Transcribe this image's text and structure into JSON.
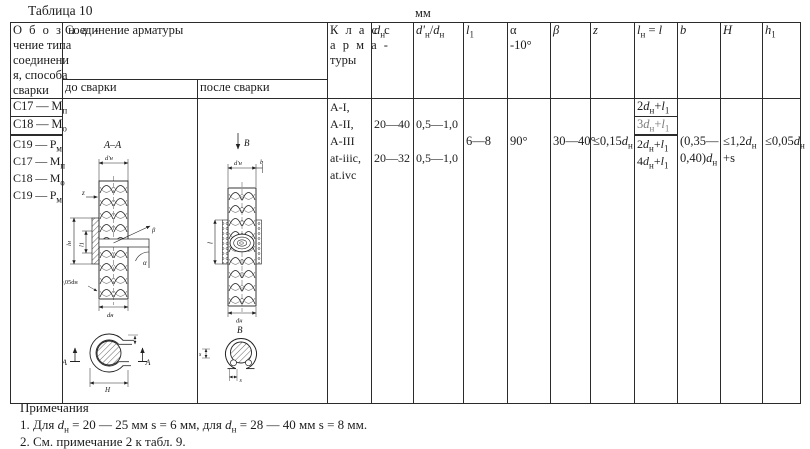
{
  "title": "Таблица 10",
  "unit_label": "мм",
  "header": {
    "col1_lines": [
      "О б о з н а -",
      "чение типа",
      "соединени",
      "я, способа",
      "сварки"
    ],
    "group": "Соединение арматуры",
    "sub_before": "до сварки",
    "sub_after": "после сварки",
    "class_lines": [
      "К л а с с",
      "а р м а -",
      "туры"
    ],
    "d_n": [
      {
        "t": "d",
        "i": true
      },
      {
        "t": "н",
        "s": true
      }
    ],
    "d_ratio": [
      {
        "t": "d'",
        "i": true
      },
      {
        "t": "н",
        "s": true
      },
      "/",
      {
        "t": "d",
        "i": true
      },
      {
        "t": "н",
        "s": true
      }
    ],
    "l_1": [
      {
        "t": "l",
        "i": true
      },
      {
        "t": "1",
        "s": true
      }
    ],
    "alpha_line1": "α",
    "alpha_line2": "-10°",
    "beta": [
      {
        "t": "β",
        "i": true
      }
    ],
    "z": [
      {
        "t": "z",
        "i": true
      }
    ],
    "l_n_eq": [
      {
        "t": "l",
        "i": true
      },
      {
        "t": "н",
        "s": true
      },
      " = ",
      {
        "t": "l",
        "i": true
      }
    ],
    "b": [
      {
        "t": "b",
        "i": true
      }
    ],
    "H": [
      {
        "t": "H",
        "i": true
      }
    ],
    "h_1": [
      {
        "t": "h",
        "i": true
      },
      {
        "t": "1",
        "s": true
      }
    ]
  },
  "rows": {
    "designation_r1": [
      "С17 — М",
      {
        "t": "п",
        "s": true
      }
    ],
    "designation_r2": [
      "С18 — М",
      {
        "t": "о",
        "s": true
      }
    ],
    "designation_r3": [
      [
        "С19 — Р",
        {
          "t": "м",
          "s": true
        }
      ],
      [
        "С17 — М",
        {
          "t": "п",
          "s": true
        }
      ],
      [
        "С18 — М",
        {
          "t": "о",
          "s": true
        }
      ],
      [
        "С19 — Р",
        {
          "t": "м",
          "s": true
        }
      ]
    ],
    "class_lines": [
      "A-I,",
      "A-II,",
      "A-III",
      "at-iiic,",
      "at.ivc"
    ],
    "d_n_lines": [
      "",
      "20—40",
      "",
      "20—32"
    ],
    "d_ratio_lines": [
      "",
      "0,5—1,0",
      "",
      "0,5—1,0"
    ],
    "l_1_val": "6—8",
    "alpha_val": "90°",
    "beta_val": "30—40°",
    "z_val": [
      "≤0,15",
      {
        "t": "d",
        "i": true
      },
      {
        "t": "н",
        "s": true
      }
    ],
    "l_n_r1": [
      "2",
      {
        "t": "d",
        "i": true
      },
      {
        "t": "н",
        "s": true
      },
      "+",
      {
        "t": "l",
        "i": true
      },
      {
        "t": "1",
        "s": true
      }
    ],
    "l_n_r2": [
      "3",
      {
        "t": "d",
        "i": true
      },
      {
        "t": "н",
        "s": true
      },
      "+",
      {
        "t": "l",
        "i": true
      },
      {
        "t": "1",
        "s": true
      }
    ],
    "l_n_r3a": [
      "2",
      {
        "t": "d",
        "i": true
      },
      {
        "t": "н",
        "s": true
      },
      "+",
      {
        "t": "l",
        "i": true
      },
      {
        "t": "1",
        "s": true
      }
    ],
    "l_n_r3b": [
      "4",
      {
        "t": "d",
        "i": true
      },
      {
        "t": "н",
        "s": true
      },
      "+",
      {
        "t": "l",
        "i": true
      },
      {
        "t": "1",
        "s": true
      }
    ],
    "b_line1": "(0,35—",
    "b_line2": [
      "0,40)",
      {
        "t": "d",
        "i": true
      },
      {
        "t": "н",
        "s": true
      }
    ],
    "H_line1": [
      "≤1,2",
      {
        "t": "d",
        "i": true
      },
      {
        "t": "н",
        "s": true
      }
    ],
    "H_line2": "+s",
    "h_1_val": [
      "≤0,05",
      {
        "t": "d",
        "i": true
      },
      {
        "t": "н",
        "s": true
      }
    ]
  },
  "drawings": {
    "before": {
      "section": "А–А",
      "d_top": "d'н",
      "z": "z",
      "beta": "β",
      "alpha": "α",
      "dim_l1": "l1",
      "dim_ln": "lн",
      "note": "≤0,05dн",
      "d_bot": "dн",
      "sec_mark": "А",
      "h_dim": "Н"
    },
    "after": {
      "view_mark": "В",
      "d_top": "d'н",
      "b": "b",
      "dim_l": "l",
      "d_bot": "dн",
      "view_label": "В",
      "s": "s"
    }
  },
  "notes": {
    "heading": "Примечания",
    "note1": [
      "1. Для ",
      {
        "t": "d",
        "i": true
      },
      {
        "t": "н",
        "s": true
      },
      " = 20 — 25 мм s = 6 мм, для ",
      {
        "t": "d",
        "i": true
      },
      {
        "t": "н",
        "s": true
      },
      " = 28 — 40 мм s = 8 мм."
    ],
    "note2": "2. См. примечание 2 к табл. 9."
  }
}
